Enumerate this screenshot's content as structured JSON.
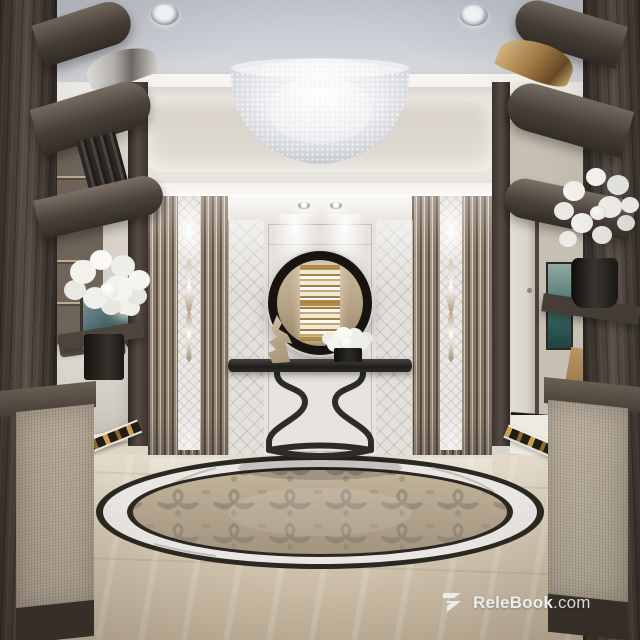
{
  "watermark": {
    "logo_name": "relebook-logo",
    "brand": "ReleBook",
    "suffix": ".com"
  },
  "palette": {
    "ceiling_gray": "#c9cdd4",
    "cove_white": "#f5f3ef",
    "wall_panel": "#e6e3de",
    "slat_light": "#d8cdbf",
    "slat_dark": "#5f5243",
    "dark_wood": "#463e36",
    "floor_beige": "#d3c6b0",
    "medallion_center": "#b3a48c",
    "mirror_frame_black": "#17140f",
    "gold_accent": "#b98f4e",
    "art_teal": "#47666b",
    "watermark_text": "#ededed"
  },
  "scene": {
    "setting": "luxury foyer interior render",
    "objects": [
      "crystal-dome-chandelier",
      "recessed-downlights",
      "cove-tray-ceiling",
      "round-black-mirror",
      "console-table",
      "white-rose-centerpiece",
      "flame-sculpture",
      "crystal-wall-sconces",
      "slatted-wood-pillars",
      "quilted-wall-panels",
      "marble-floor-medallion",
      "mosaic-floor-border",
      "living-room-sofa",
      "abstract-teal-artwork",
      "table-lamp",
      "hallway-door",
      "orchid-arrangement",
      "dark-wood-display-shelves",
      "upholstered-cabinets"
    ]
  }
}
